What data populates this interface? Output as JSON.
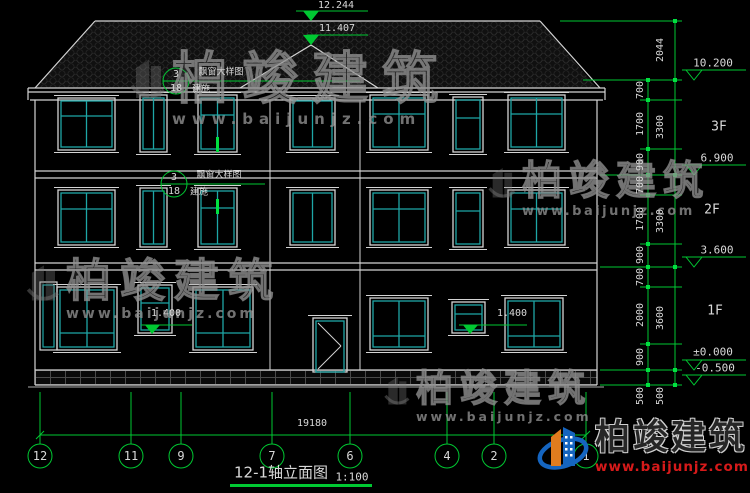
{
  "title": {
    "name": "12-1轴立面图",
    "scale": "1:100"
  },
  "top_markers": [
    "12.244",
    "11.407"
  ],
  "right_markers": [
    "10.200",
    "6.900",
    "3.600",
    "±0.000",
    "-0.500"
  ],
  "floor_labels": [
    "3F",
    "2F",
    "1F"
  ],
  "inner_dims": [
    "700",
    "1700",
    "900",
    "700",
    "1700",
    "900",
    "700",
    "2000",
    "900",
    "500"
  ],
  "outer_dims": [
    "2044",
    "3300",
    "3300",
    "3600",
    "500"
  ],
  "bottom_dim": "19180",
  "sill_markers": [
    "1.400",
    "1.400"
  ],
  "axes": [
    "12",
    "11",
    "9",
    "7",
    "6",
    "4",
    "2",
    "1"
  ],
  "callout": {
    "detail_no": "3",
    "sheet_no": "18",
    "label": "飘窗大样图",
    "sublabel": "建施"
  },
  "watermark": {
    "brand": "柏竣建筑",
    "url": "www.baijunjz.com"
  },
  "colors": {
    "background": "#000000",
    "line_white": "#d4d4d4",
    "window_cyan": "#1ea6a6",
    "annotation_green": "#00c832",
    "watermark_gray": "#7a7a7a",
    "logo_blue": "#1565c0",
    "logo_orange": "#e07c1e",
    "url_red": "#d61a1a"
  }
}
